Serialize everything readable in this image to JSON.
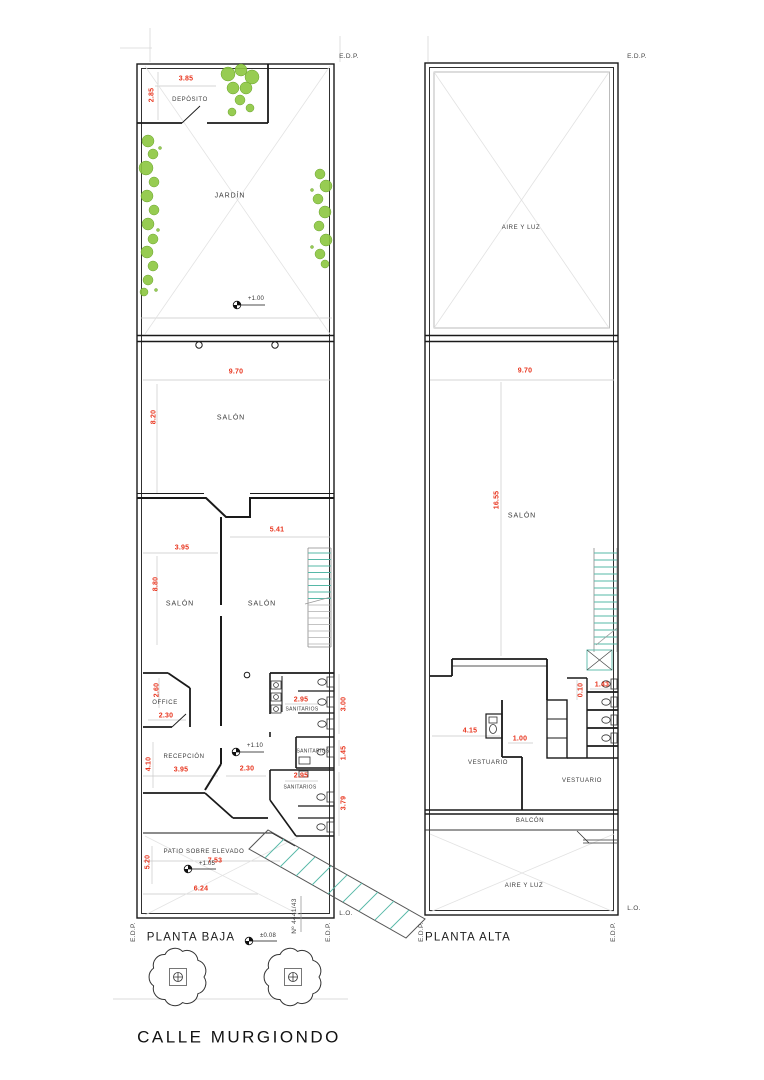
{
  "street_name": "CALLE MURGIONDO",
  "colors": {
    "dimension_red": "#e8341d",
    "stair_teal": "#56b8a7",
    "tree_green": "#8cc63f",
    "line_black": "#1a1a1a",
    "guide_gray": "#c9c9c9"
  },
  "planta_baja": {
    "title": "PLANTA BAJA",
    "markers": {
      "edp_top": "E.D.P.",
      "edp_bottom_left": "E.D.P.",
      "edp_bottom_right": "E.D.P.",
      "lo": "L.O.",
      "street_number": "Nº 4441/43"
    },
    "rooms": {
      "deposito": "DEPÓSITO",
      "jardin": "JARDÍN",
      "salon_front": "SALÓN",
      "salon_mid_left": "SALÓN",
      "salon_mid_right": "SALÓN",
      "office": "OFFICE",
      "recepcion": "RECEPCIÓN",
      "sanitarios_1": "SANITARIOS",
      "sanitarios_2": "SANITARIOS",
      "sanitarios_3": "SANITARIOS",
      "patio": "PATIO SOBRE ELEVADO"
    },
    "dims": {
      "deposito_w": "3.85",
      "deposito_h": "2.85",
      "salon_front_w": "9.70",
      "salon_front_h": "8.20",
      "salon_mid_right_w": "5.41",
      "salon_mid_left_w": "3.95",
      "salon_mid_left_h": "8.80",
      "office_h": "2.60",
      "office_w": "2.30",
      "recepcion_h": "4.10",
      "recepcion_w": "3.95",
      "pasillo_w": "2.30",
      "sanitarios_1_w": "2.95",
      "sanitarios_1_h": "3.00",
      "sanitarios_2_h": "1.45",
      "sanitarios_3_w": "2.95",
      "sanitarios_3_h": "3.79",
      "patio_w": "7.53",
      "patio_h": "5.20",
      "patio_w2": "6.24"
    },
    "levels": {
      "jardin": "+1.00",
      "recepcion": "+1.10",
      "patio": "+1.05",
      "vereda": "±0.08"
    }
  },
  "planta_alta": {
    "title": "PLANTA ALTA",
    "markers": {
      "edp_top": "E.D.P.",
      "edp_bottom_left": "E.D.P.",
      "edp_bottom_right": "E.D.P.",
      "lo": "L.O."
    },
    "rooms": {
      "aire_luz_frente": "AIRE Y LUZ",
      "salon": "SALÓN",
      "vestuario_1": "VESTUARIO",
      "vestuario_2": "VESTUARIO",
      "balcon": "BALCÓN",
      "aire_luz_fondo": "AIRE Y LUZ"
    },
    "dims": {
      "salon_w": "9.70",
      "salon_h": "16.55",
      "box_gap": "0.10",
      "box_w": "1.43",
      "vestuario_w": "4.15",
      "paso_w": "1.00"
    }
  }
}
